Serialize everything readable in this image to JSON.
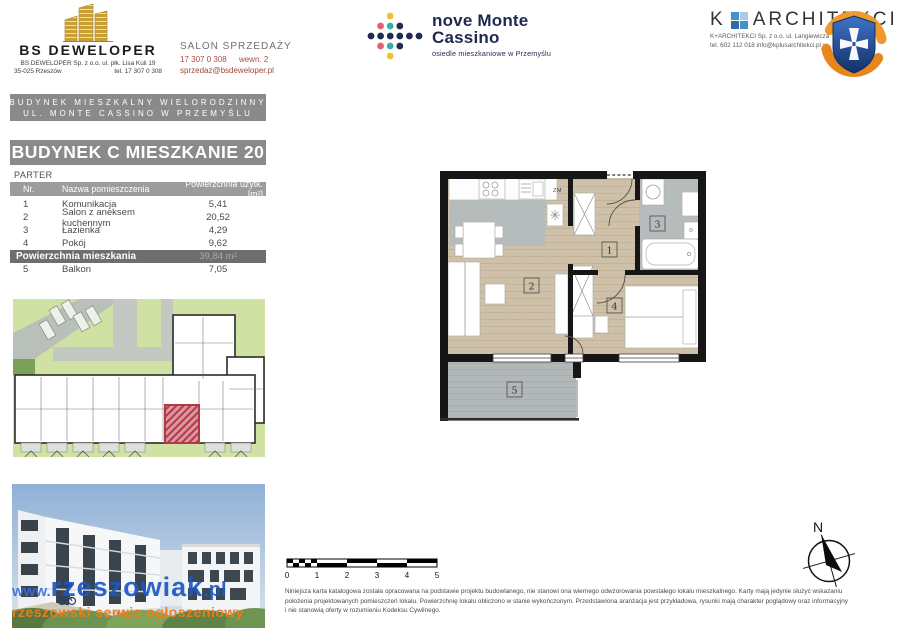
{
  "header": {
    "developer": {
      "name": "BS DEWELOPER",
      "address_line1": "BS DEWELOPER Sp. z o.o. ul. płk. Lisa Kuli 19",
      "address_city": "35-025 Rzeszów",
      "address_phone": "tel. 17 307 0 308"
    },
    "sales_office": {
      "title": "SALON SPRZEDAŻY",
      "phone": "17 307 0 308",
      "phone_ext": "wewn. 2",
      "email": "sprzedaz@bsdeweloper.pl"
    },
    "estate": {
      "name_line1": "nove Monte",
      "name_line2": "Cassino",
      "subtitle": "osiedle mieszkaniowe w Przemyślu"
    },
    "architect": {
      "name_prefix": "K",
      "name_rest": "ARCHITEKCI",
      "info_line1": "K+ARCHITEKCI Sp. z o.o. ul. Langiewicza",
      "info_line2": "tel. 602 112 018  info@kplusarchitekci.pl  w"
    }
  },
  "project_bar": {
    "line1": "BUDYNEK MIESZKALNY WIELORODZINNY",
    "line2": "UL. MONTE CASSINO W PRZEMYŚLU"
  },
  "unit_title": "BUDYNEK C MIESZKANIE 20",
  "floor_label": "PARTER",
  "area_table": {
    "col_nr": "Nr.",
    "col_name": "Nazwa pomieszczenia",
    "col_area": "Powierzchnia użytk. [m²]",
    "rows": [
      {
        "nr": "1",
        "name": "Komunikacja",
        "area": "5,41"
      },
      {
        "nr": "2",
        "name": "Salon z aneksem kuchennym",
        "area": "20,52"
      },
      {
        "nr": "3",
        "name": "Łazienka",
        "area": "4,29"
      },
      {
        "nr": "4",
        "name": "Pokój",
        "area": "9,62"
      }
    ],
    "total_label": "Powierzchnia mieszkania",
    "total_value": "39,84 m²",
    "balcony_row": {
      "nr": "5",
      "name": "Balkon",
      "area": "7,05"
    }
  },
  "floor_plan": {
    "room_labels": [
      "1",
      "2",
      "3",
      "4",
      "5"
    ],
    "zm_label": "ZM"
  },
  "scale_bar": {
    "ticks": [
      "0",
      "1",
      "2",
      "3",
      "4",
      "5"
    ]
  },
  "compass": {
    "north": "N"
  },
  "watermark": {
    "prefix": "www.",
    "main": "rzeszowiak",
    "suffix": ".pl",
    "line2": "rzeszowski serwis ogłoszeniowy"
  },
  "disclaimer": {
    "line1": "Niniejsza karta katalogowa została opracowana na podstawie projektu budowlanego, nie stanowi ona wiernego odwzorowania powstałego lokalu mieszkalnego. Karty mają jedynie służyć wskazaniu",
    "line2": "położenia projektowanych pomieszczeń lokalu. Powierzchnię lokalu obliczono w stanie wykończonym. Przedstawiona aranżacja jest przykładowa, rysunki mają charakter poglądowy oraz informacyjny",
    "line3": "i nie stanowią oferty w rozumieniu Kodeksu Cywilnego."
  },
  "colors": {
    "navy": "#1d2950",
    "gold": "#c9a035",
    "sales_red": "#b5483e",
    "bar_gray": "#8a8a8a",
    "total_gray": "#6e6e6e",
    "unit_highlight_red": "#b23a48",
    "watermark_blue": "#1b57c8",
    "watermark_orange": "#ef7d1a",
    "plan_wood": "#cfc1a9",
    "plan_tile_gray": "#b6bbbc"
  }
}
